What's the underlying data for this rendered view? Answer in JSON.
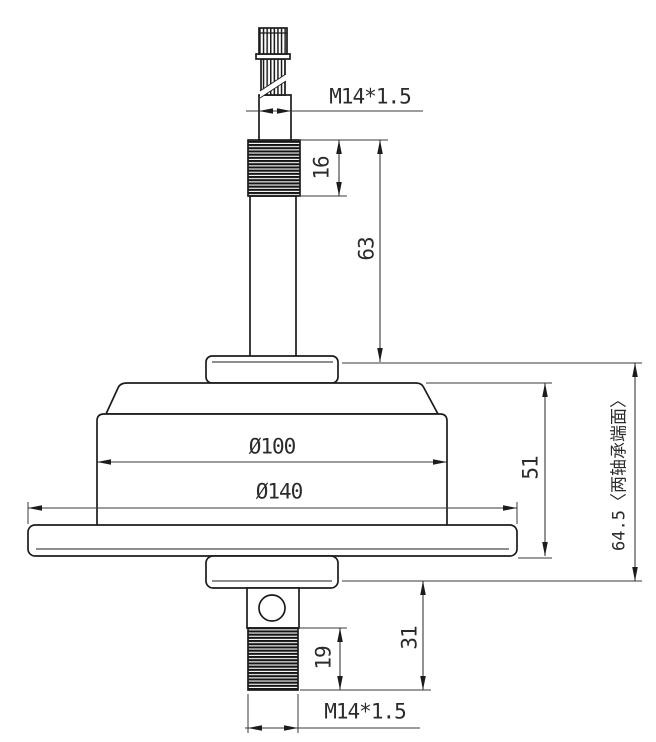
{
  "drawing": {
    "kind": "engineering-dimension-drawing",
    "view": "side elevation of a flanged motor hub with threaded shaft ends",
    "colors": {
      "background": "#ffffff",
      "part_outline": "#1c1c1c",
      "dimension_lines": "#3a3a3a",
      "text": "#2b2b2b"
    },
    "dimensions": {
      "top_thread_callout": "M14*1.5",
      "top_thread_length": "16",
      "top_shaft_length": "63",
      "body_diameter": "Ø100",
      "flange_diameter": "Ø140",
      "housing_height": "51",
      "bearing_face_span": "64.5〈两轴承端面〉",
      "bottom_shaft_length": "31",
      "bottom_thread_length": "19",
      "bottom_thread_callout": "M14*1.5"
    }
  }
}
